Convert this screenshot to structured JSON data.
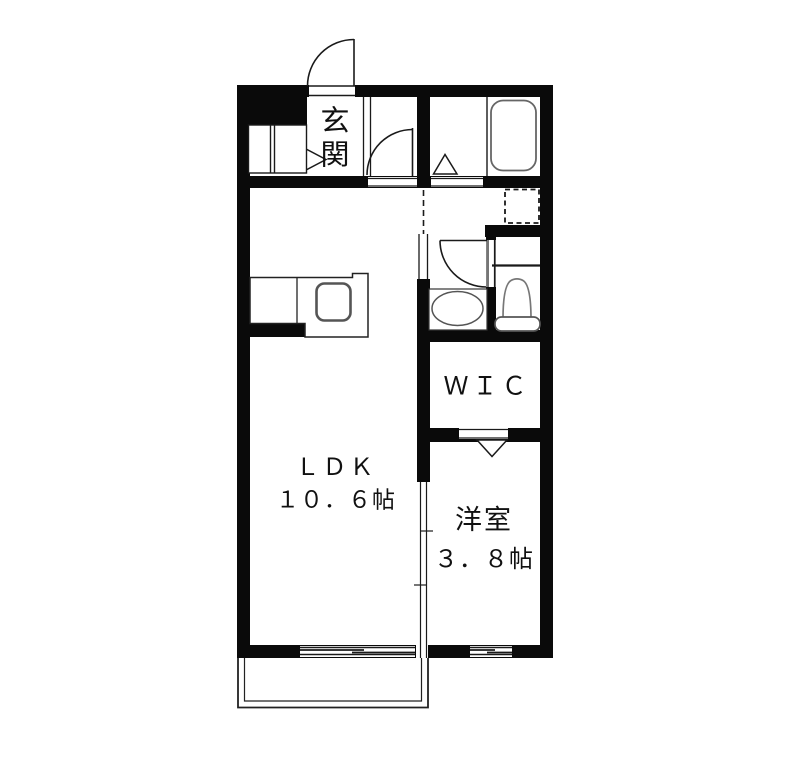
{
  "rooms": {
    "entrance": {
      "label": "玄関"
    },
    "ldk": {
      "label": "ＬＤＫ",
      "area": "１０．６帖"
    },
    "wic": {
      "label": "ＷＩＣ"
    },
    "western": {
      "label": "洋室",
      "area": "３．８帖"
    }
  },
  "fixtures": {
    "bathtub": "bathtub",
    "toilet": "toilet",
    "washbasin": "washbasin-oval",
    "kitchen_sink": "kitchen-sink",
    "washing_machine_pan": "washing-machine-pan-dashed",
    "shoe_cabinet": "shoe-cabinet",
    "balcony": "balcony-railing"
  },
  "symbols": {
    "entrance_door": "swing-door-arc",
    "hall_door": "swing-door-arc",
    "toilet_door": "swing-door-arc",
    "bath_door": "folding-door-triangle",
    "wic_door": "folding-door-triangle",
    "entrance_step": "step-triangle",
    "ldk_western_divider": "sliding-door",
    "windows": "sliding-window"
  },
  "colors": {
    "background": "#ffffff",
    "wall": "#0a0a0a",
    "line": "#1a1a1a",
    "fixture_line": "#666666"
  }
}
